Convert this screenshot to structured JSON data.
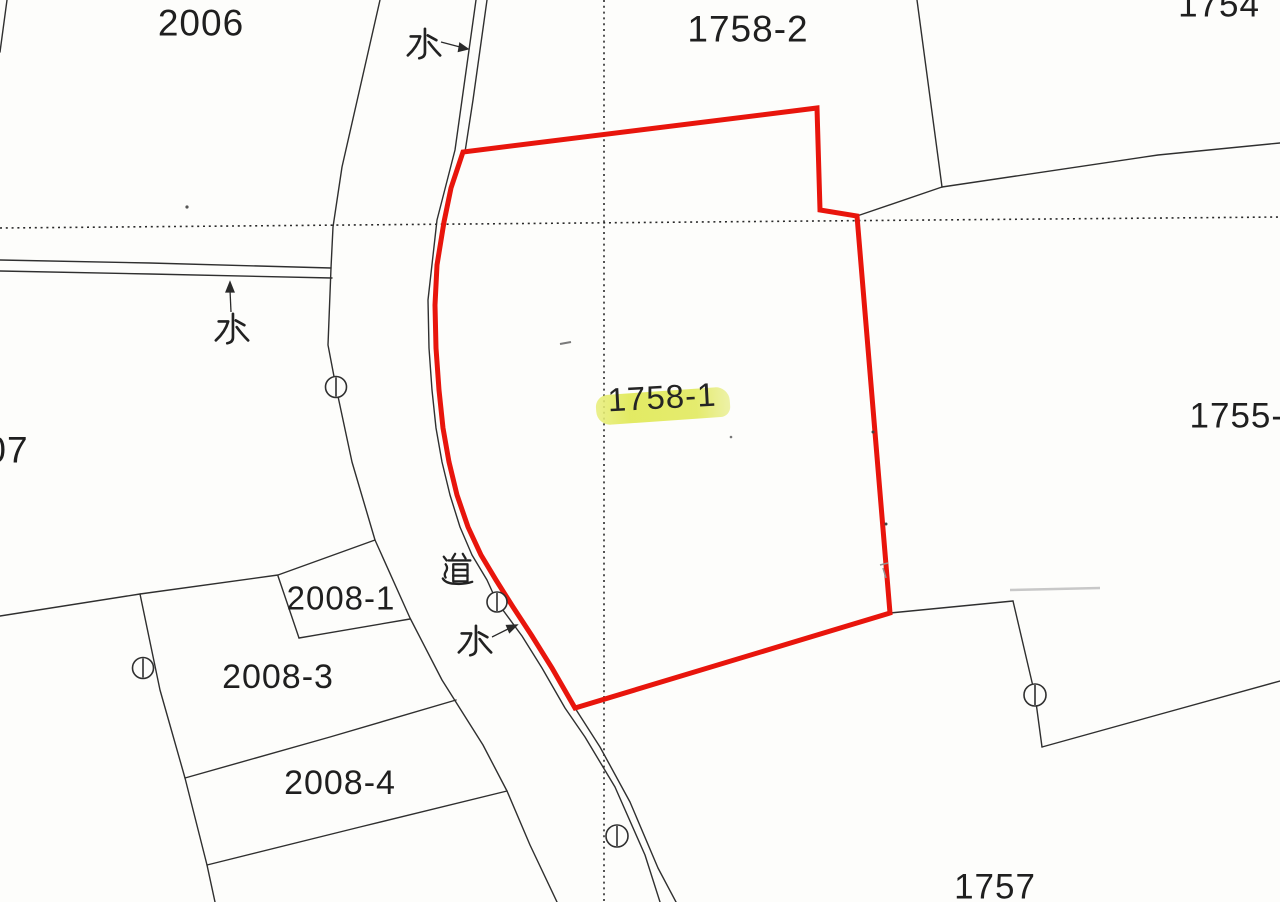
{
  "map": {
    "title": "japanese-cadastral-map-scan",
    "highlighted_parcel": "1758-1",
    "parcel_labels": {
      "p2006": "2006",
      "p1758_2": "1758-2",
      "p1754": "1754",
      "p07": "07",
      "p1755_2": "1755-2",
      "p1758_1": "1758-1",
      "p2008_1": "2008-1",
      "p2008_3": "2008-3",
      "p2008_4": "2008-4",
      "p1757": "1757"
    },
    "feature_labels": {
      "water": "水",
      "road": "道"
    },
    "colors": {
      "selection_boundary": "#e8150c",
      "highlight": "#e1e95b",
      "line": "#2f2f2f",
      "paper": "#fdfdfb"
    },
    "symbols": {
      "survey_marker": "circle-with-vertical-tick",
      "survey_marker_count": 5
    }
  }
}
